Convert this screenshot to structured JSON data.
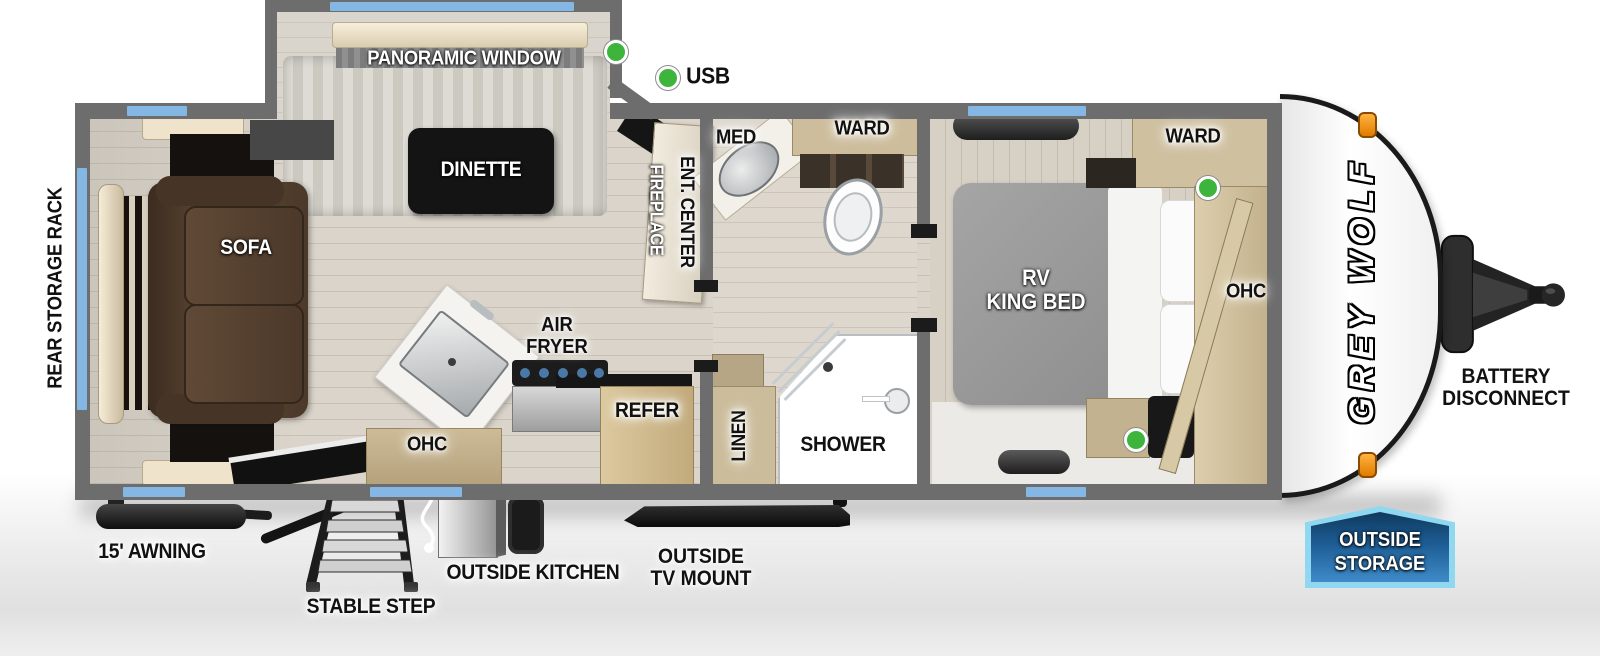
{
  "floorplan": {
    "slideout": {
      "panoramic_window": "PANORAMIC WINDOW",
      "dinette": "DINETTE"
    },
    "legend": {
      "usb": "USB"
    },
    "living": {
      "sofa": "SOFA",
      "rear_storage_rack": "REAR STORAGE RACK",
      "fireplace": "FIREPLACE",
      "ent_center": "ENT. CENTER"
    },
    "kitchen": {
      "air_fryer_line1": "AIR",
      "air_fryer_line2": "FRYER",
      "ohc": "OHC",
      "refer": "REFER"
    },
    "bathroom": {
      "med": "MED",
      "ward": "WARD",
      "shower": "SHOWER",
      "linen": "LINEN"
    },
    "bedroom": {
      "bed_line1": "RV",
      "bed_line2": "KING BED",
      "ward": "WARD",
      "ohc": "OHC"
    }
  },
  "exterior": {
    "brand": "GREY WOLF",
    "battery_line1": "BATTERY",
    "battery_line2": "DISCONNECT",
    "awning": "15' AWNING",
    "stable_step": "STABLE STEP",
    "outside_kitchen": "OUTSIDE KITCHEN",
    "tv_mount_line1": "OUTSIDE",
    "tv_mount_line2": "TV MOUNT",
    "storage_badge_line1": "OUTSIDE",
    "storage_badge_line2": "STORAGE"
  },
  "colors": {
    "window_accent": "#84b7e4",
    "usb_indicator": "#3db53d",
    "badge_fill": "#1d5c93",
    "badge_border": "#8fd8f0",
    "wall_gray": "#6d6d6d"
  }
}
